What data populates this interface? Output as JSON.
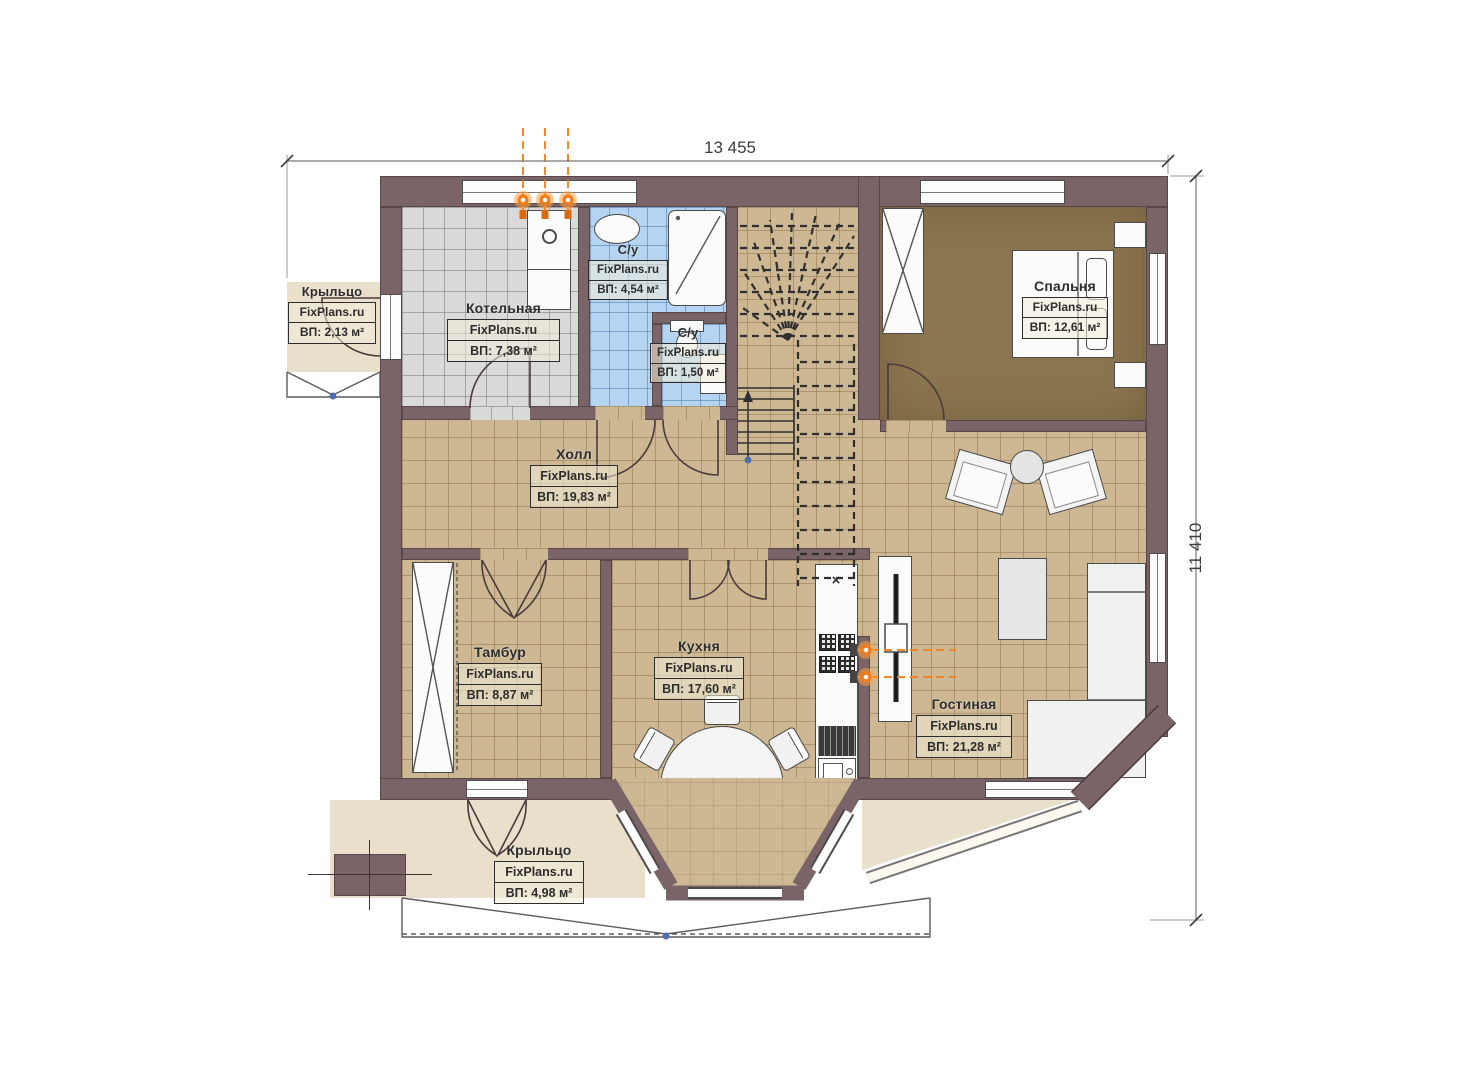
{
  "plan": {
    "dimensions": {
      "top": "13 455",
      "right": "11 410"
    },
    "rooms": [
      {
        "name": "Крыльцо",
        "brand": "FixPlans.ru",
        "area": "ВП: 2,13 м²"
      },
      {
        "name": "Котельная",
        "brand": "FixPlans.ru",
        "area": "ВП: 7,38 м²"
      },
      {
        "name": "С/у",
        "brand": "FixPlans.ru",
        "area": "ВП: 4,54 м²"
      },
      {
        "name": "С/у",
        "brand": "FixPlans.ru",
        "area": "ВП: 1,50 м²"
      },
      {
        "name": "Спальня",
        "brand": "FixPlans.ru",
        "area": "ВП: 12,61 м²"
      },
      {
        "name": "Холл",
        "brand": "FixPlans.ru",
        "area": "ВП: 19,83 м²"
      },
      {
        "name": "Тамбур",
        "brand": "FixPlans.ru",
        "area": "ВП: 8,87 м²"
      },
      {
        "name": "Кухня",
        "brand": "FixPlans.ru",
        "area": "ВП: 17,60 м²"
      },
      {
        "name": "Гостиная",
        "brand": "FixPlans.ru",
        "area": "ВП: 21,28 м²"
      },
      {
        "name": "Крыльцо",
        "brand": "FixPlans.ru",
        "area": "ВП: 4,98 м²"
      }
    ],
    "marks": {
      "cross": "×"
    },
    "colors": {
      "wall": "#7b6467",
      "tile": "#cdb893",
      "boiler_tile": "#dadada",
      "bath_tile": "#b5d4f1",
      "bedroom_floor": "#8b754f",
      "porch": "#e9dfca",
      "gas": "#f58220"
    }
  }
}
